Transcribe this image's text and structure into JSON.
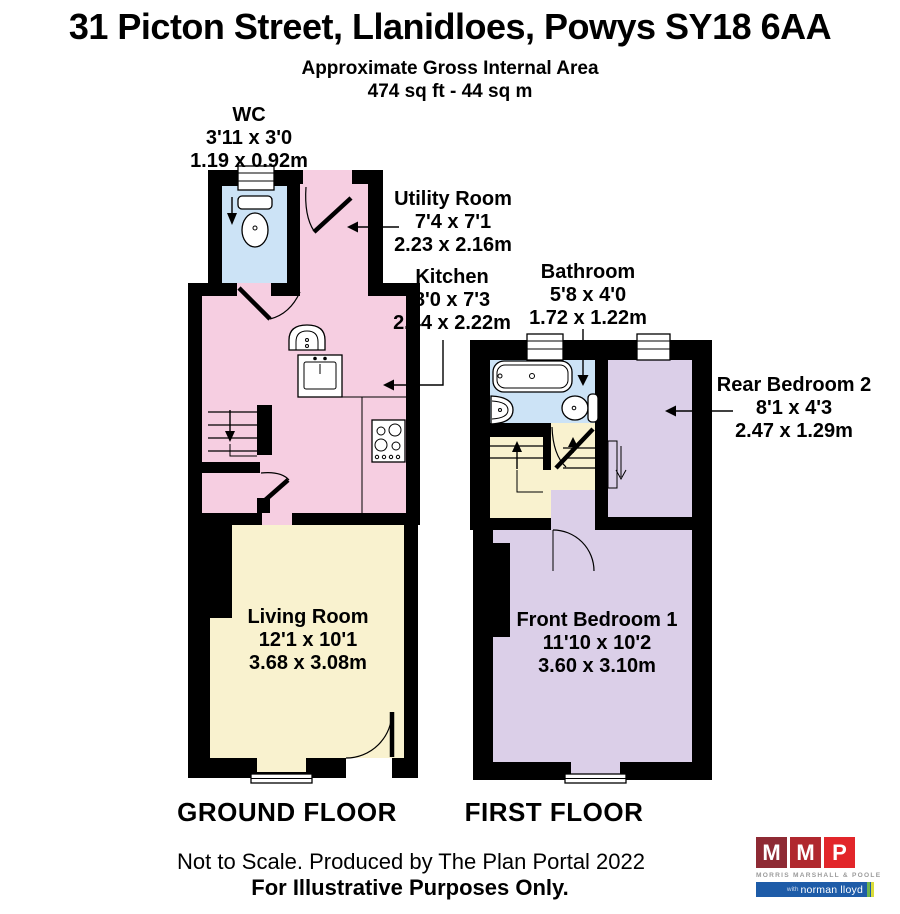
{
  "header": {
    "title": "31 Picton Street, Llanidloes, Powys SY18 6AA",
    "subtitle1": "Approximate Gross Internal Area",
    "subtitle2": "474 sq ft - 44 sq m"
  },
  "rooms": [
    {
      "name": "WC",
      "dims_ft": "3'11 x 3'0",
      "dims_m": "1.19 x 0.92m"
    },
    {
      "name": "Utility Room",
      "dims_ft": "7'4 x 7'1",
      "dims_m": "2.23 x 2.16m"
    },
    {
      "name": "Kitchen",
      "dims_ft": "8'0 x 7'3",
      "dims_m": "2.44 x 2.22m"
    },
    {
      "name": "Bathroom",
      "dims_ft": "5'8 x 4'0",
      "dims_m": "1.72 x 1.22m"
    },
    {
      "name": "Rear Bedroom 2",
      "dims_ft": "8'1 x 4'3",
      "dims_m": "2.47 x 1.29m"
    },
    {
      "name": "Living Room",
      "dims_ft": "12'1 x 10'1",
      "dims_m": "3.68 x 3.08m"
    },
    {
      "name": "Front Bedroom 1",
      "dims_ft": "11'10 x 10'2",
      "dims_m": "3.60 x 3.10m"
    }
  ],
  "floors": {
    "ground": "GROUND FLOOR",
    "first": "FIRST FLOOR"
  },
  "footer": {
    "line1": "Not to Scale. Produced by The Plan Portal 2022",
    "line2": "For Illustrative Purposes Only."
  },
  "logo": {
    "letters": [
      "M",
      "M",
      "P"
    ],
    "company": "MORRIS MARSHALL & POOLE",
    "tagline_with": "with",
    "tagline_name": "norman lloyd"
  },
  "colors": {
    "room_pink": "#F6CEE1",
    "room_blue": "#CCE3F6",
    "room_cream": "#F9F2CF",
    "room_lavender": "#DBCFE8",
    "wall": "#000000",
    "logo_red_dark": "#8E2A34",
    "logo_red_mid": "#B0282E",
    "logo_red_bright": "#E2262A",
    "logo_gray": "#9B9B9B",
    "logo_blue": "#1E5CA8",
    "logo_green": "#6FB44D",
    "logo_lime": "#D9DD3C"
  }
}
